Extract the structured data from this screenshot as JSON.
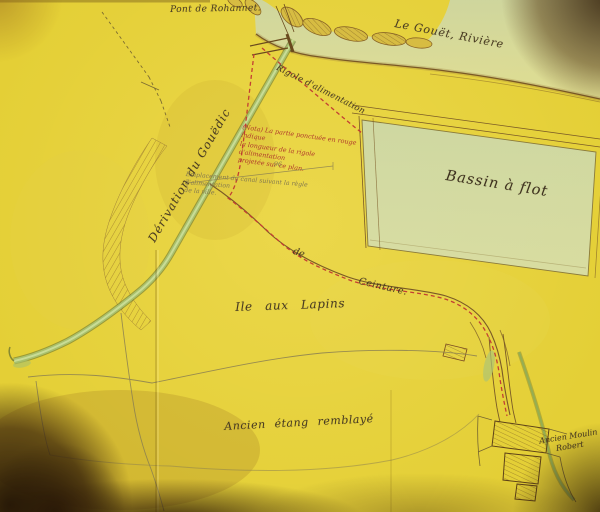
{
  "map": {
    "labels": {
      "pont": "Pont de Rohannet.",
      "riviere": "Le Gouët, Rivière",
      "derivation": "Dérivation du Gouëdic",
      "rigole": "Rigole d'alimentation",
      "nota_l1": "(Nota) La partie ponctuée en rouge indique",
      "nota_l2": "la longueur de la rigole d'alimentation",
      "nota_l3": "projetée sur ce plan.",
      "pencil_number": "96",
      "pencil_l1": "Emplacement du canal suivant la règle d'alimentation",
      "pencil_l2": "de la ville.",
      "de": "de",
      "ceinture": "Ceinture.",
      "ile": "Ile aux Lapins",
      "bassin": "Bassin à flot",
      "etang": "Ancien étang remblayé",
      "moulin_l1": "Ancien Moulin",
      "moulin_l2": "Robert"
    },
    "colors": {
      "paper": "#e4cf36",
      "water_wash": "#d4dcae",
      "canal_green": "#a9c16d",
      "ink_brown": "#6e5424",
      "red_ink": "#b43a2c",
      "pencil": "#857a4e",
      "handwriting": "#473a22",
      "vignette": "#2e1d06"
    }
  }
}
